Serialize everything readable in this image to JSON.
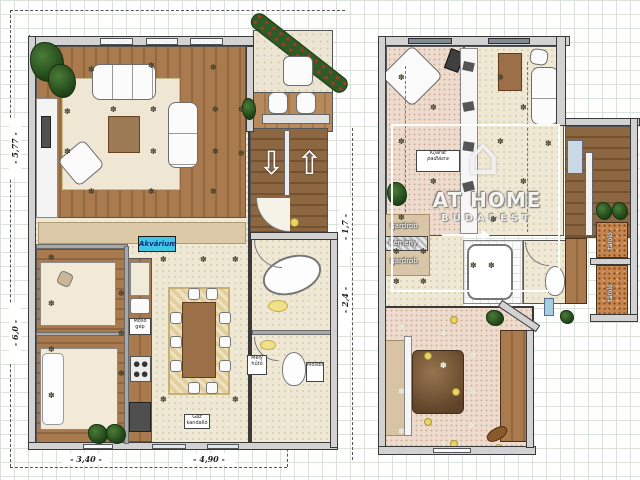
{
  "plan": {
    "type": "residential floor plan, two storeys on grid paper",
    "floors": [
      "ground-floor",
      "upper-floor"
    ]
  },
  "watermark": {
    "brand": "AT HOME",
    "city": "BUDAPEST"
  },
  "dimensions": {
    "left_upper": "- 5,77 -",
    "left_lower": "- 6,0 -",
    "mid_upper": "- 1,7 -",
    "mid_lower": "- 2,4 -",
    "bottom_left": "- 3,40 -",
    "bottom_right": "- 4,90 -"
  },
  "labels": {
    "aquarium": "Akvárium",
    "washer": "Mosó\ngép",
    "freezer": "Mély\nhűtő",
    "fireplace": "Gáz\nkandalló",
    "basin": "Mosdó",
    "attic_exit": "Kijárat\npadlásra",
    "wardrobe_upper": "gardrob",
    "chimney": "Kémény",
    "wardrobe_lower": "gardrob",
    "storage_upper": "tároló",
    "storage_lower": "tároló"
  },
  "symbols": {
    "flower": "✽",
    "arrow_up": "⇧",
    "arrow_down": "⇩",
    "house_icon": "⌂"
  },
  "colors": {
    "accent_cyan": "#41c7e6",
    "wood": "#a87a4e",
    "wall_fill": "#d2d2d2",
    "plant_green": "#2f5b26",
    "cork": "#c5864f",
    "rug_gold": "#e3cf9c"
  }
}
